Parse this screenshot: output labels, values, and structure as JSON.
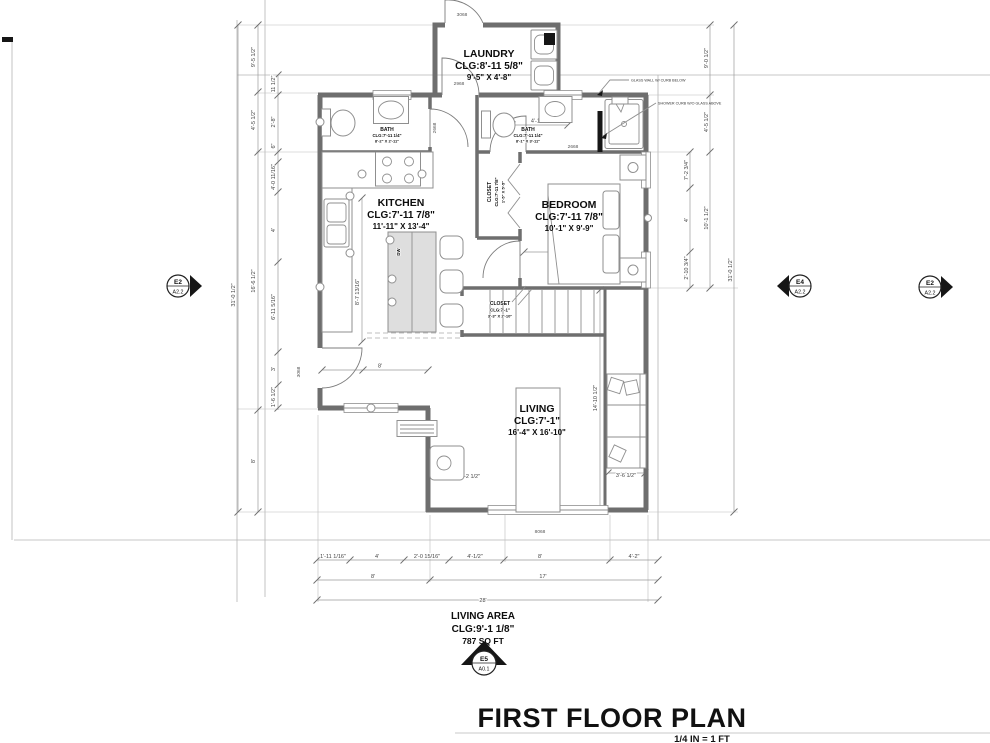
{
  "title_block": {
    "title": "FIRST FLOOR PLAN",
    "scale": "1/4 IN = 1 FT"
  },
  "summary": {
    "name": "LIVING AREA",
    "clg": "CLG:9'-1 1/8\"",
    "area": "787 SQ FT"
  },
  "rooms": {
    "laundry": {
      "name": "LAUNDRY",
      "clg": "CLG:8'-11 5/8\"",
      "dims": "9'-5\" X 4'-8\""
    },
    "bath1": {
      "name": "BATH",
      "clg": "CLG:7'-11 1/4\"",
      "dims": "8'-2\" X 2'-11\""
    },
    "kitchen": {
      "name": "KITCHEN",
      "clg": "CLG:7'-11 7/8\"",
      "dims": "11'-11\" X 13'-4\""
    },
    "closet1": {
      "name": "CLOSET",
      "clg": "CLG:7'-11 7/8\"",
      "dims": "1'-5\" X 5'-5\""
    },
    "bedroom": {
      "name": "BEDROOM",
      "clg": "CLG:7'-11 7/8\"",
      "dims": "10'-1\" X 9'-9\""
    },
    "bath2": {
      "name": "BATH",
      "clg": "CLG:7'-11 1/4\"",
      "dims": "8'-1\" X 3'-11\""
    },
    "closet2": {
      "name": "CLOSET",
      "clg": "CLG:7'-1\"",
      "dims": "3'-3\" X 2'-10\""
    },
    "living": {
      "name": "LIVING",
      "clg": "CLG:7'-1\"",
      "dims": "16'-4\" X 16'-10\""
    }
  },
  "markers": {
    "left": {
      "top": "E2",
      "bottom": "A2.2"
    },
    "right_inner": {
      "top": "E4",
      "bottom": "A2.2"
    },
    "right_outer": {
      "top": "E2",
      "bottom": "A2.2"
    },
    "bottom": {
      "top": "E5",
      "bottom": "A0.1"
    }
  },
  "annotations": {
    "glass_wall": "GLASS WALL W/ CURB BELOW",
    "shower_curb": "SHOWER CURB W/O GLASS ABOVE"
  },
  "openings": {
    "top_door": "3068",
    "laundry_door": "2968",
    "bath1_door": "2668",
    "bath2_door": "2668",
    "entry_door": "3068",
    "living_window": "8068"
  },
  "fixtures": {
    "dishwasher": "DW"
  },
  "dims": {
    "left_outer": "31'-0 1/2\"",
    "left_mid": [
      "9'-5 1/2\"",
      "4'-5 1/2\"",
      "16'-6 1/2\"",
      "8'"
    ],
    "left_inner": [
      "11 1/2\"",
      "2'-8\"",
      "6\"",
      "4'-0 11/16\"",
      "4'",
      "6'-11 5/16\"",
      "3'",
      "1'-6 1/2\""
    ],
    "right_inner": [
      "7'-2 3/4\"",
      "4'",
      "2'-10 3/4\""
    ],
    "right_mid": [
      "9'-0 1/2\"",
      "4'-5 1/2\"",
      "10'-1 1/2\""
    ],
    "right_outer": "31'-0 1/2\"",
    "bottom_row1": [
      "1'-11 1/16\"",
      "4'",
      "2'-0 15/16\"",
      "4'-1/2\"",
      "8'",
      "4'-2\""
    ],
    "bottom_row2": [
      "8'",
      "17'"
    ],
    "bottom_row3": "28'",
    "interior": {
      "hall": "8'",
      "kitchen_v": "8'-7 13/16\"",
      "bed_w": "11'-11 1/2\"",
      "bath2_w": "4'-1 1/2\"",
      "sofa_h": "14'-10 1/2\"",
      "sofa_w": "3'-6 1/2\"",
      "equip": "4'-2 1/2\""
    }
  }
}
